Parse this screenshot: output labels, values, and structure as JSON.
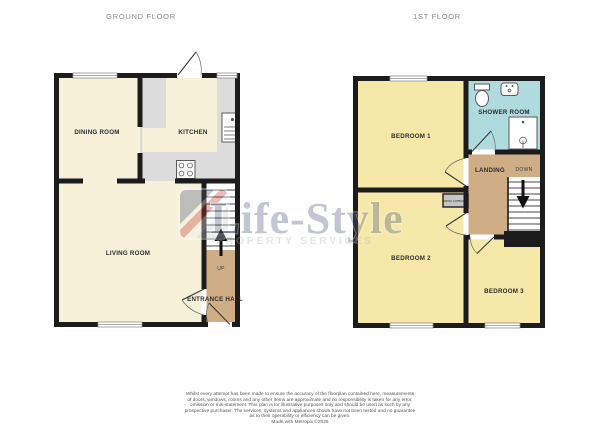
{
  "ground_floor": {
    "title": "GROUND FLOOR",
    "rooms": {
      "dining_room": "DINING ROOM",
      "kitchen": "KITCHEN",
      "living_room": "LIVING ROOM",
      "entrance_hall": "ENTRANCE HALL"
    },
    "stairs_label": "UP"
  },
  "first_floor": {
    "title": "1ST FLOOR",
    "rooms": {
      "bedroom1": "BEDROOM 1",
      "shower_room": "SHOWER ROOM",
      "landing": "LANDING",
      "bedroom2": "BEDROOM 2",
      "bedroom3": "BEDROOM 3"
    },
    "stairs_label": "DOWN",
    "airing_cupboard_label": "AIRING CUPBOARD"
  },
  "watermark": {
    "brand": "Life-Style",
    "tagline": "PROPERTY SERVICES"
  },
  "disclaimer": {
    "lines": [
      "Whilst every attempt has been made to ensure the accuracy of the floorplan contained here, measurements",
      "of doors, windows, rooms and any other items are approximate and no responsibility is taken for any error,",
      "omission or mis-statement. This plan is for illustrative purposes only and should be used as such by any",
      "prospective purchaser. The services, systems and appliances shown have not been tested and no guarantee",
      "as to their operability or efficiency can be given.",
      "Made with Metropix ©2025"
    ]
  },
  "colors": {
    "wall": "#1c1c1c",
    "cream": "#f7f1da",
    "yellow": "#f5e8a8",
    "teal": "#b0dbde",
    "tan": "#cfae85",
    "counter": "#dcdcdc",
    "cupboard": "#c6c6c6",
    "label": "#2d2d2d",
    "title": "#8c8c8c",
    "disclaimer": "#555555",
    "wm_slate": "#4e5a78",
    "wm_red": "#c43b31",
    "wm_gray": "#b3b7c0",
    "fixture": "#5a5a5a",
    "window": "#8f8f8f"
  }
}
